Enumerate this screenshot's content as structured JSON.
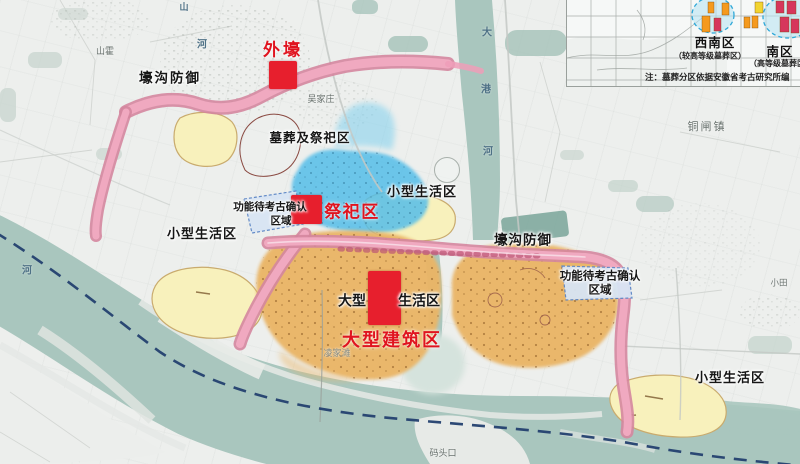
{
  "labels": {
    "red": {
      "outer_moat": "外壕",
      "sacrificial": "祭祀区",
      "large_building": "大型建筑区"
    },
    "zones": {
      "moat_defense": "壕沟防御",
      "burial_sacrificial": "墓葬及祭祀区",
      "small_living": "小型生活区",
      "pending_line1": "功能待考古确认",
      "pending_line2": "区域",
      "large_living_prefix": "大型",
      "large_living_suffix": "生活区"
    },
    "places": {
      "shanhuo": "山霍",
      "wujiazhuang": "吴家庄",
      "tongzhazhen": "铜闸镇",
      "xiaotian": "小田",
      "lingjiatan": "凌家滩",
      "matoukou": "码头口",
      "he_left": "河",
      "shan_top": "山",
      "he_top": "河",
      "dagang_chars": [
        "大",
        "港",
        "河"
      ]
    }
  },
  "inset": {
    "sw_label": "西南区",
    "sw_sub": "（较高等级墓葬区）",
    "s_label": "南区",
    "s_sub": "（高等级墓葬区）",
    "note": "注：墓葬分区依据安徽省考古研究所编",
    "bars": [
      {
        "x": 135,
        "y": 16,
        "w": 8,
        "h": 16,
        "color": "bar_orange"
      },
      {
        "x": 141,
        "y": 2,
        "w": 6,
        "h": 11,
        "color": "bar_orange"
      },
      {
        "x": 155,
        "y": 3,
        "w": 7,
        "h": 12,
        "color": "bar_orange"
      },
      {
        "x": 147,
        "y": 18,
        "w": 7,
        "h": 13,
        "color": "bar_red"
      },
      {
        "x": 188,
        "y": 2,
        "w": 8,
        "h": 11,
        "color": "bar_yellow"
      },
      {
        "x": 177,
        "y": 17,
        "w": 6,
        "h": 11,
        "color": "bar_orange"
      },
      {
        "x": 185,
        "y": 16,
        "w": 6,
        "h": 12,
        "color": "bar_orange"
      },
      {
        "x": 209,
        "y": 1,
        "w": 8,
        "h": 12,
        "color": "bar_red"
      },
      {
        "x": 220,
        "y": 1,
        "w": 9,
        "h": 13,
        "color": "bar_red"
      },
      {
        "x": 213,
        "y": 17,
        "w": 9,
        "h": 15,
        "color": "bar_red"
      },
      {
        "x": 224,
        "y": 19,
        "w": 8,
        "h": 14,
        "color": "bar_red"
      }
    ]
  },
  "colors": {
    "river": "#a9c6be",
    "moat_pink": "#ef9db9",
    "moat_edge": "#d4869f",
    "settlement_orange": "#eab566",
    "living_yellow": "#f8f1bc",
    "sacrificial_blue": "#55bee9",
    "pending_blue": "#d8e5f4",
    "marker_red": "#e71f2d",
    "bar_orange": "#f59a1e",
    "bar_red": "#d6365c",
    "bar_yellow": "#f2d430",
    "channel_navy": "#23406f"
  }
}
